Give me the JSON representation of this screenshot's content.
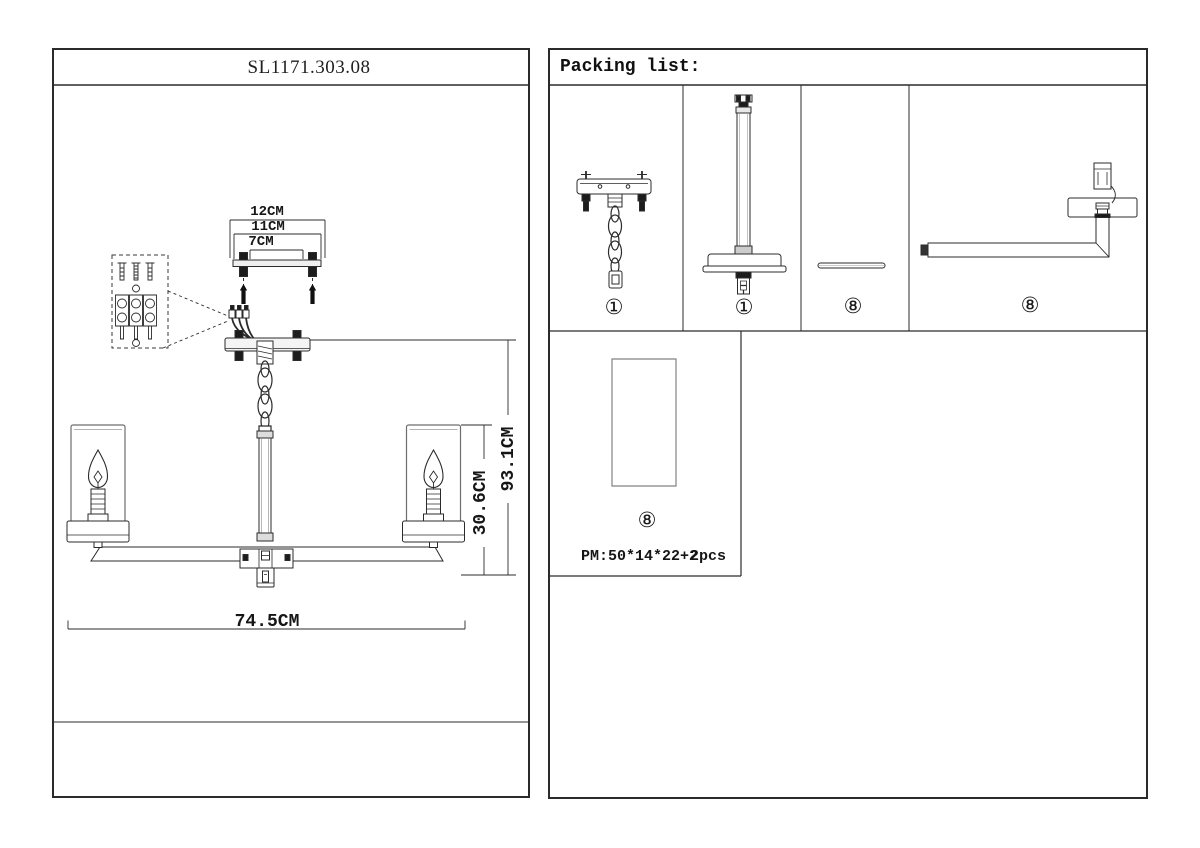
{
  "left_panel": {
    "title": "SL1171.303.08",
    "dims": {
      "plate_outer": "12CM",
      "plate_mid": "11CM",
      "plate_inner": "7CM",
      "shade_drop": "30.6CM",
      "total_height": "93.1CM",
      "total_width": "74.5CM"
    }
  },
  "right_panel": {
    "header": "Packing list:",
    "items": [
      {
        "id": "ceiling-bracket-with-chain",
        "label": "①"
      },
      {
        "id": "down-rod-with-canopy",
        "label": "①"
      },
      {
        "id": "connector-rod",
        "label": "⑧"
      },
      {
        "id": "lamp-arm",
        "label": "⑧"
      },
      {
        "id": "glass-shade",
        "label": "⑧"
      }
    ],
    "package_note": {
      "size": "PM:50*14*22+2",
      "qty": "2pcs"
    }
  }
}
